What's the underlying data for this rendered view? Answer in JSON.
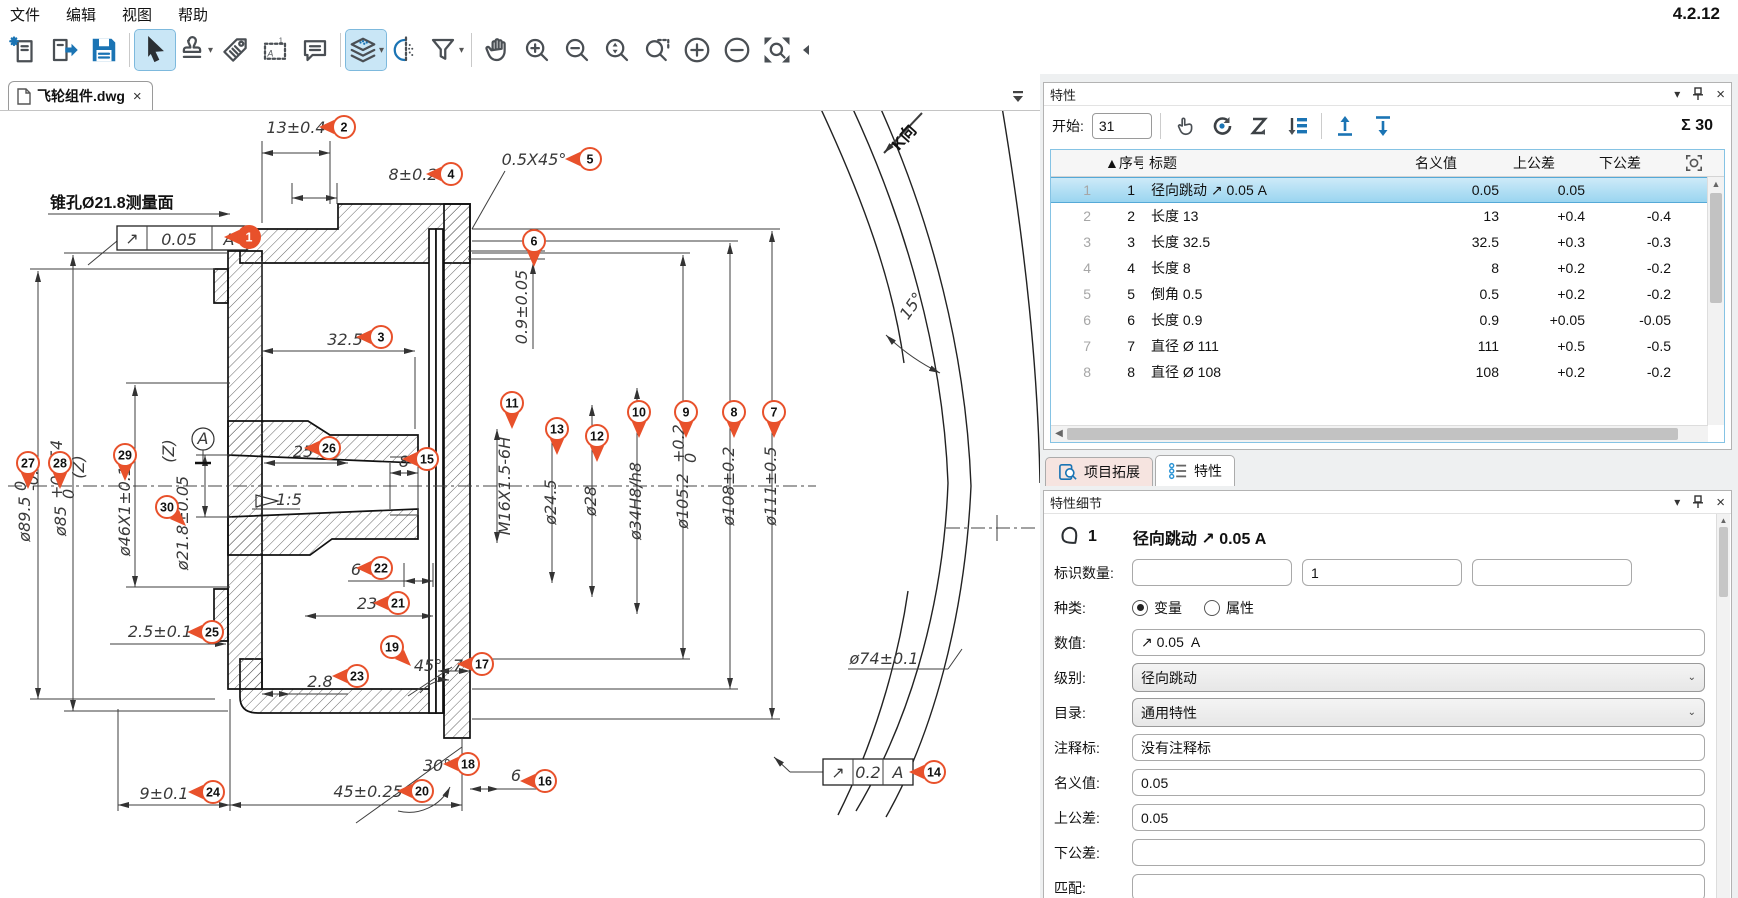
{
  "app": {
    "version": "4.2.12"
  },
  "menu": {
    "items": [
      "文件",
      "编辑",
      "视图",
      "帮助"
    ]
  },
  "toolbar": {
    "icons": [
      "new-document",
      "open-document",
      "save",
      "select-cursor",
      "stamp-tool",
      "tag-tool",
      "region-note-tool",
      "comment-tool",
      "layers-tool",
      "mirror-view-tool",
      "filter-tool",
      "pan-hand",
      "zoom-in",
      "zoom-out",
      "zoom-selection",
      "zoom-window",
      "increase",
      "decrease",
      "zoom-extents",
      "collapse-toolbar"
    ]
  },
  "document_tab": {
    "title": "飞轮组件.dwg",
    "close": "×"
  },
  "characteristics_panel": {
    "title": "特性",
    "start_label": "开始:",
    "start_value": "31",
    "sum_label": "Σ 30",
    "toolbar_icons": [
      "pick-hand",
      "renumber-rotate",
      "renumber-zigzag",
      "renumber-list",
      "export-up",
      "import-down"
    ],
    "table": {
      "columns": [
        "",
        "▲序号",
        "标题",
        "名义值",
        "上公差",
        "下公差"
      ],
      "rows": [
        {
          "index": "1",
          "num": "1",
          "title": "径向跳动 ↗ 0.05 A",
          "nominal": "0.05",
          "upper": "0.05",
          "lower": "",
          "selected": true
        },
        {
          "index": "2",
          "num": "2",
          "title": "长度 13",
          "nominal": "13",
          "upper": "+0.4",
          "lower": "-0.4",
          "selected": false
        },
        {
          "index": "3",
          "num": "3",
          "title": "长度 32.5",
          "nominal": "32.5",
          "upper": "+0.3",
          "lower": "-0.3",
          "selected": false
        },
        {
          "index": "4",
          "num": "4",
          "title": "长度 8",
          "nominal": "8",
          "upper": "+0.2",
          "lower": "-0.2",
          "selected": false
        },
        {
          "index": "5",
          "num": "5",
          "title": "倒角 0.5",
          "nominal": "0.5",
          "upper": "+0.2",
          "lower": "-0.2",
          "selected": false
        },
        {
          "index": "6",
          "num": "6",
          "title": "长度 0.9",
          "nominal": "0.9",
          "upper": "+0.05",
          "lower": "-0.05",
          "selected": false
        },
        {
          "index": "7",
          "num": "7",
          "title": "直径 Ø 111",
          "nominal": "111",
          "upper": "+0.5",
          "lower": "-0.5",
          "selected": false
        },
        {
          "index": "8",
          "num": "8",
          "title": "直径 Ø 108",
          "nominal": "108",
          "upper": "+0.2",
          "lower": "-0.2",
          "selected": false
        }
      ]
    }
  },
  "bottom_tabs": [
    {
      "label": "项目拓展",
      "active": false
    },
    {
      "label": "特性",
      "active": true
    }
  ],
  "detail_panel": {
    "title": "特性细节",
    "item_number": "1",
    "item_title": "径向跳动 ↗ 0.05 A",
    "id_count_label": "标识数量:",
    "id_values": [
      "",
      "1",
      ""
    ],
    "kind_label": "种类:",
    "kind_options": [
      {
        "label": "变量",
        "checked": true
      },
      {
        "label": "属性",
        "checked": false
      }
    ],
    "value_label": "数值:",
    "value": "↗ 0.05  A",
    "level_label": "级别:",
    "level": "径向跳动",
    "catalog_label": "目录:",
    "catalog": "通用特性",
    "note_label": "注释标:",
    "note": "没有注释标",
    "nominal_label": "名义值:",
    "nominal": "0.05",
    "upper_label": "上公差:",
    "upper": "0.05",
    "lower_label": "下公差:",
    "lower": "",
    "match_label": "匹配:",
    "match": ""
  },
  "colors": {
    "balloon": "#e8512b",
    "accent_blue": "#1b74b4",
    "selection_blue": "#9ad5f0"
  },
  "drawing": {
    "balloons": [
      {
        "n": "1",
        "x": 249,
        "y": 126,
        "dir": "left",
        "sel": true
      },
      {
        "n": "2",
        "x": 344,
        "y": 16,
        "dir": "left"
      },
      {
        "n": "3",
        "x": 381,
        "y": 226,
        "dir": "left"
      },
      {
        "n": "4",
        "x": 451,
        "y": 63,
        "dir": "left"
      },
      {
        "n": "5",
        "x": 590,
        "y": 48,
        "dir": "left"
      },
      {
        "n": "6",
        "x": 534,
        "y": 130,
        "dir": "down"
      },
      {
        "n": "7",
        "x": 774,
        "y": 301,
        "dir": "down"
      },
      {
        "n": "8",
        "x": 734,
        "y": 301,
        "dir": "down"
      },
      {
        "n": "9",
        "x": 686,
        "y": 301,
        "dir": "down"
      },
      {
        "n": "10",
        "x": 639,
        "y": 301,
        "dir": "down"
      },
      {
        "n": "11",
        "x": 512,
        "y": 292,
        "dir": "down"
      },
      {
        "n": "12",
        "x": 597,
        "y": 325,
        "dir": "down"
      },
      {
        "n": "13",
        "x": 557,
        "y": 318,
        "dir": "down"
      },
      {
        "n": "14",
        "x": 934,
        "y": 661,
        "dir": "left"
      },
      {
        "n": "15",
        "x": 427,
        "y": 348,
        "dir": "left"
      },
      {
        "n": "16",
        "x": 545,
        "y": 670,
        "dir": "left"
      },
      {
        "n": "17",
        "x": 482,
        "y": 553,
        "dir": "left"
      },
      {
        "n": "18",
        "x": 468,
        "y": 653,
        "dir": "left"
      },
      {
        "n": "19",
        "x": 392,
        "y": 536,
        "dir": "dr"
      },
      {
        "n": "20",
        "x": 422,
        "y": 680,
        "dir": "left"
      },
      {
        "n": "21",
        "x": 398,
        "y": 492,
        "dir": "left"
      },
      {
        "n": "22",
        "x": 381,
        "y": 457,
        "dir": "left"
      },
      {
        "n": "23",
        "x": 357,
        "y": 565,
        "dir": "left"
      },
      {
        "n": "24",
        "x": 213,
        "y": 681,
        "dir": "left"
      },
      {
        "n": "25",
        "x": 212,
        "y": 521,
        "dir": "left"
      },
      {
        "n": "26",
        "x": 329,
        "y": 337,
        "dir": "left"
      },
      {
        "n": "27",
        "x": 28,
        "y": 352,
        "dir": "down"
      },
      {
        "n": "28",
        "x": 60,
        "y": 352,
        "dir": "down"
      },
      {
        "n": "29",
        "x": 125,
        "y": 344,
        "dir": "down"
      },
      {
        "n": "30",
        "x": 167,
        "y": 396,
        "dir": "dr"
      }
    ],
    "texts": [
      {
        "t": "13±0.4",
        "x": 296,
        "y": 22
      },
      {
        "t": "8±0.2",
        "x": 413,
        "y": 69
      },
      {
        "t": "0.5X45°",
        "x": 534,
        "y": 54
      },
      {
        "t": "锥孔Ø21.8测量面",
        "x": 50,
        "y": 97,
        "cls": "cn",
        "anchor": "start"
      },
      {
        "t": "↗",
        "x": 132,
        "y": 133,
        "size": 14
      },
      {
        "t": "0.05",
        "x": 179,
        "y": 134,
        "size": 15
      },
      {
        "t": "A",
        "x": 229,
        "y": 134,
        "size": 15
      },
      {
        "t": "0.9±0.05",
        "x": 527,
        "y": 196,
        "rot": -90
      },
      {
        "t": "32.5",
        "x": 345,
        "y": 234
      },
      {
        "t": "25",
        "x": 303,
        "y": 346
      },
      {
        "t": "8",
        "x": 404,
        "y": 356
      },
      {
        "t": "1:5",
        "x": 289,
        "y": 394
      },
      {
        "t": "M16X1.5-6H",
        "x": 510,
        "y": 375,
        "rot": -90
      },
      {
        "t": "ø24.5",
        "x": 556,
        "y": 391,
        "rot": -90
      },
      {
        "t": "ø28",
        "x": 596,
        "y": 390,
        "rot": -90
      },
      {
        "t": "ø34H8/h8",
        "x": 641,
        "y": 390,
        "rot": -90
      },
      {
        "t": "ø105.2",
        "x": 688,
        "y": 390,
        "rot": -90
      },
      {
        "t": "+0.2",
        "x": 684,
        "y": 352,
        "rot": -90,
        "size": 11,
        "anchor": "start"
      },
      {
        "t": "0",
        "x": 696,
        "y": 352,
        "rot": -90,
        "size": 11,
        "anchor": "start"
      },
      {
        "t": "ø108±0.2",
        "x": 734,
        "y": 375,
        "rot": -90
      },
      {
        "t": "ø111±0.5",
        "x": 776,
        "y": 375,
        "rot": -90
      },
      {
        "t": "ø89.5",
        "x": 30,
        "y": 408,
        "rot": -90
      },
      {
        "t": "0",
        "x": 26,
        "y": 380,
        "rot": -90,
        "size": 11,
        "anchor": "start"
      },
      {
        "t": "-0.3",
        "x": 38,
        "y": 380,
        "rot": -90,
        "size": 11,
        "anchor": "start"
      },
      {
        "t": "ø85",
        "x": 66,
        "y": 410,
        "rot": -90
      },
      {
        "t": "+0.054",
        "x": 62,
        "y": 388,
        "rot": -90,
        "size": 11,
        "anchor": "start"
      },
      {
        "t": "0",
        "x": 74,
        "y": 388,
        "rot": -90,
        "size": 11,
        "anchor": "start"
      },
      {
        "t": "(Z)",
        "x": 84,
        "y": 356,
        "rot": -90
      },
      {
        "t": "ø46X1±0.1",
        "x": 130,
        "y": 400,
        "rot": -90
      },
      {
        "t": "(Z)",
        "x": 174,
        "y": 340,
        "rot": -90
      },
      {
        "t": "ø21.8±0.05",
        "x": 188,
        "y": 412,
        "rot": -90
      },
      {
        "t": "A",
        "x": 203,
        "y": 333,
        "size": 15
      },
      {
        "t": "6",
        "x": 356,
        "y": 464
      },
      {
        "t": "23",
        "x": 367,
        "y": 498
      },
      {
        "t": "2.5±0.1",
        "x": 160,
        "y": 526
      },
      {
        "t": "2.8",
        "x": 320,
        "y": 576
      },
      {
        "t": "45°",
        "x": 428,
        "y": 560
      },
      {
        "t": "7",
        "x": 458,
        "y": 560
      },
      {
        "t": "30°",
        "x": 437,
        "y": 660
      },
      {
        "t": "6",
        "x": 516,
        "y": 670
      },
      {
        "t": "9±0.1",
        "x": 164,
        "y": 688
      },
      {
        "t": "45±0.25",
        "x": 368,
        "y": 686
      },
      {
        "t": "ø74±0.1",
        "x": 884,
        "y": 553
      },
      {
        "t": "↗",
        "x": 838,
        "y": 667,
        "size": 14
      },
      {
        "t": "0.2",
        "x": 868,
        "y": 667,
        "size": 15
      },
      {
        "t": "A",
        "x": 898,
        "y": 667,
        "size": 15
      },
      {
        "t": "K向",
        "x": 908,
        "y": 30,
        "rot": -48,
        "cls": "cn"
      },
      {
        "t": "15°",
        "x": 916,
        "y": 198,
        "rot": -55
      }
    ]
  }
}
